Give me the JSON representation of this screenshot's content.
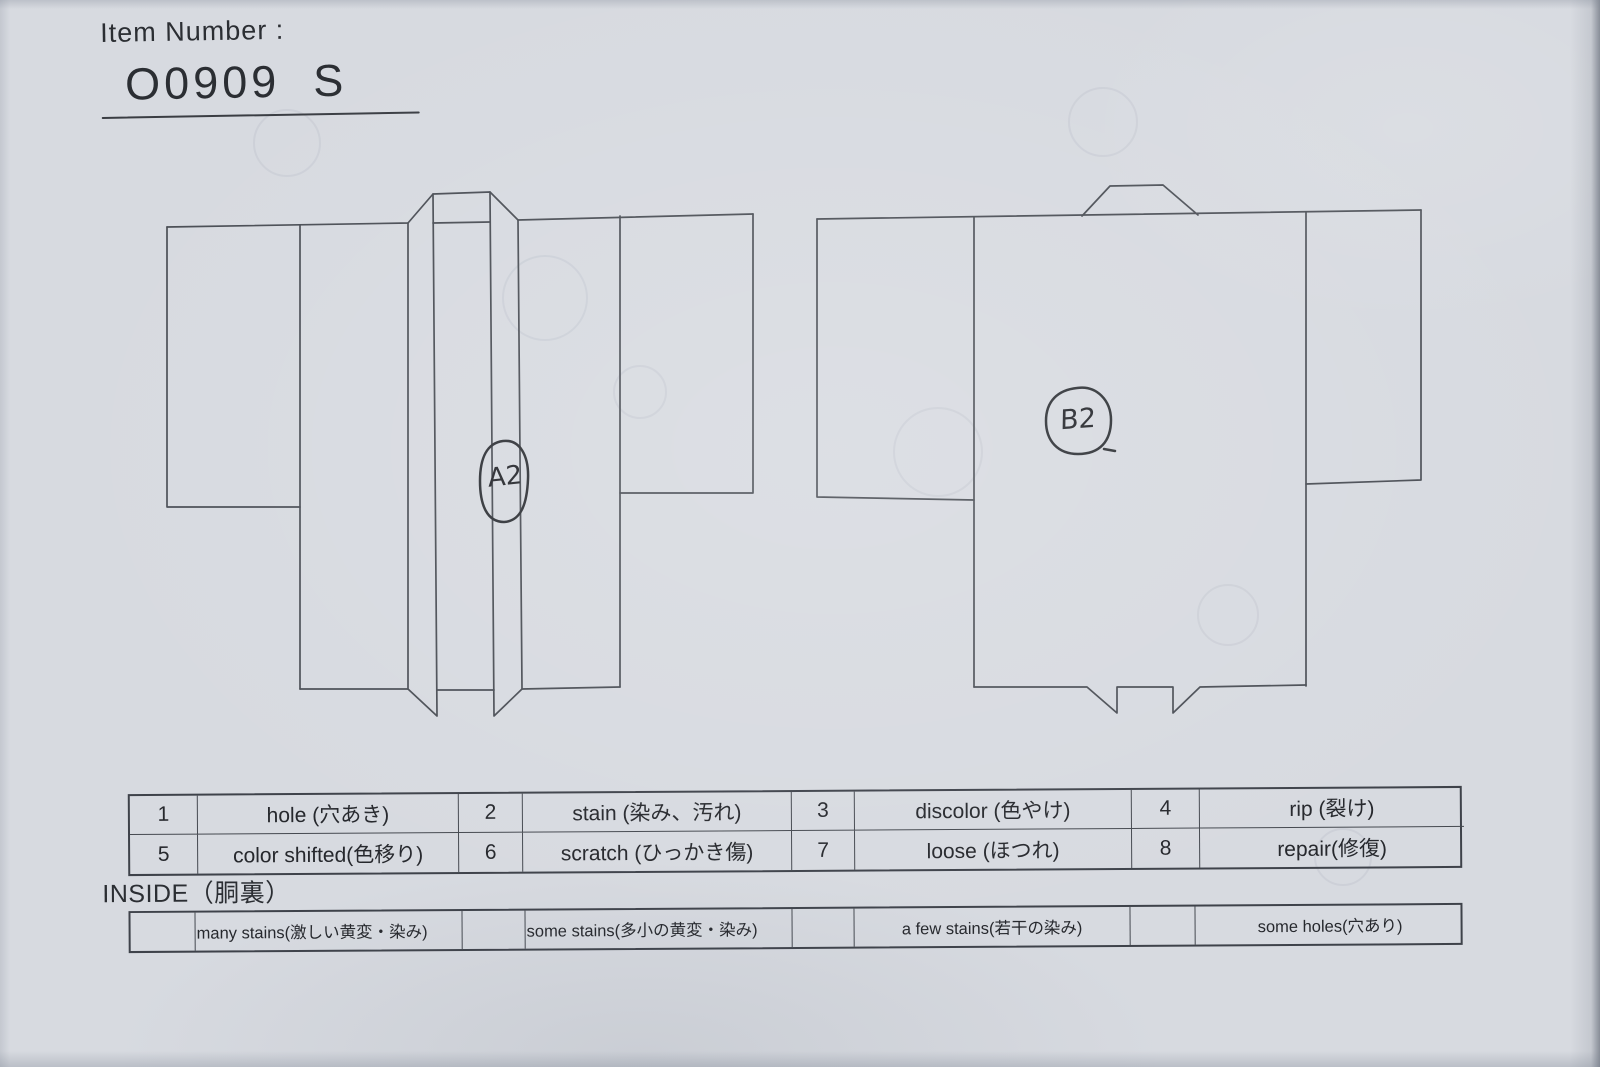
{
  "header": {
    "item_number_label": "Item Number :",
    "item_number_value": "O0909  S"
  },
  "annotations": {
    "front_code": "A2",
    "back_code": "B2"
  },
  "diagrams": {
    "front_view": "kimono front view with collar bands",
    "back_view": "kimono back view with neck band"
  },
  "defect_table": {
    "cells": [
      {
        "num": "1",
        "label": "hole (穴あき)"
      },
      {
        "num": "2",
        "label": "stain (染み、汚れ)"
      },
      {
        "num": "3",
        "label": "discolor (色やけ)"
      },
      {
        "num": "4",
        "label": "rip (裂け)"
      },
      {
        "num": "5",
        "label": "color shifted(色移り)"
      },
      {
        "num": "6",
        "label": "scratch (ひっかき傷)"
      },
      {
        "num": "7",
        "label": "loose (ほつれ)"
      },
      {
        "num": "8",
        "label": "repair(修復)"
      }
    ]
  },
  "inside": {
    "label": "INSIDE（胴裏）",
    "options": [
      "many stains(激しい黄変・染み)",
      "some stains(多小の黄変・染み)",
      "a few stains(若干の染み)",
      "some holes(穴あり)"
    ]
  },
  "colors": {
    "paper": "#d7dae0",
    "diagram_line": "#4a4e55",
    "table_border": "#3e424a",
    "ink": "#26282d"
  }
}
